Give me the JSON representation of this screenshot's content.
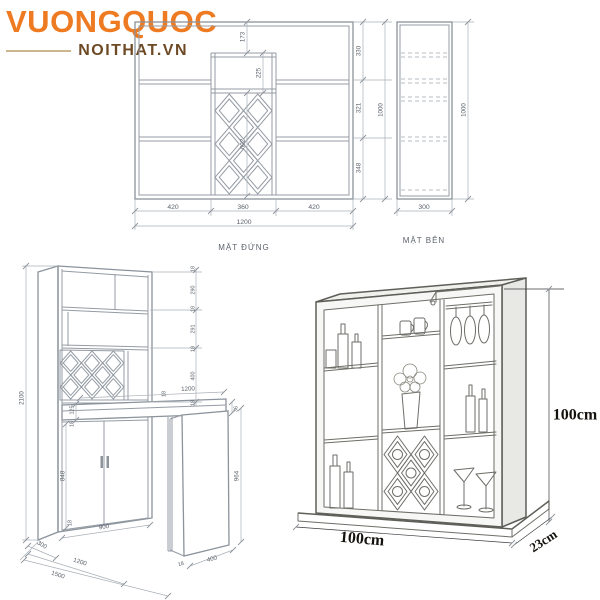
{
  "logo": {
    "brand": "VUONGQUOC",
    "site": "NOITHAT.VN"
  },
  "front_elevation": {
    "label": "MẶT ĐỨNG",
    "dims": {
      "top_gap": "173",
      "top_box": "225",
      "rack_height": "602",
      "right_1": "330",
      "right_2": "321",
      "right_3": "348",
      "height_total": "1000",
      "width_1": "420",
      "width_2": "360",
      "width_3": "420",
      "width_total": "1200"
    }
  },
  "side_view": {
    "label": "MẶT BÊN",
    "dims": {
      "height": "1000",
      "depth": "300"
    }
  },
  "iso_view": {
    "dims": {
      "height_total": "2100",
      "right_chain": [
        "18",
        "290",
        "18",
        "291",
        "18",
        "400",
        "18"
      ],
      "desk_gap": "125",
      "desk_gap_panel": "18",
      "desk_back": "18",
      "desk_length": "1200",
      "desk_thickness": "36",
      "leg_height": "964",
      "leg_width": "400",
      "leg_panel": "18",
      "door_height": "848",
      "plinth": "18",
      "door_width": "900",
      "depth": "300",
      "floor_mid": "1200",
      "floor_total": "1500"
    }
  },
  "perspective_view": {
    "dims": {
      "height": "100cm",
      "width": "100cm",
      "depth": "23cm"
    }
  }
}
